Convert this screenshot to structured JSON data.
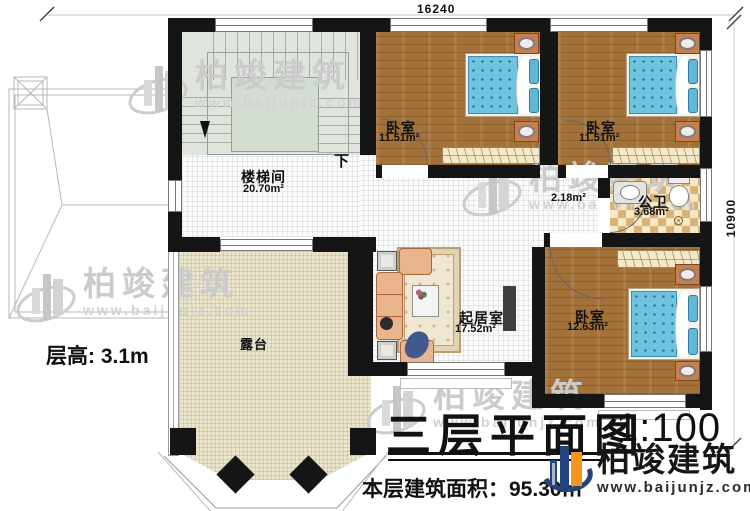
{
  "dimensions": {
    "top": "16240",
    "right": "10900"
  },
  "annotations": {
    "floor_height": "层高: 3.1m",
    "down": "下",
    "hall_area": "2.18m²"
  },
  "rooms": {
    "stairwell": {
      "name": "楼梯间",
      "area": "20.70m²"
    },
    "bedroom_a": {
      "name": "卧室",
      "area": "11.51m²"
    },
    "bedroom_b": {
      "name": "卧室",
      "area": "11.51m²"
    },
    "bathroom": {
      "name": "公卫",
      "area": "3.68m²"
    },
    "living": {
      "name": "起居室",
      "area": "17.52m²"
    },
    "bedroom_c": {
      "name": "卧室",
      "area": "12.63m²"
    },
    "terrace": {
      "name": "露台"
    }
  },
  "title_block": {
    "title": "三层平面图",
    "scale": "1:100",
    "area_note": "本层建筑面积：95.30㎡"
  },
  "brand": {
    "name": "柏竣建筑",
    "website": "www.baijunjz.com",
    "suffix": "、"
  },
  "watermark": {
    "name": "柏竣建筑",
    "website": "www.baijunjz.com"
  },
  "colors": {
    "wall": "#151515",
    "wood_floor": "#a3713a",
    "bed_blue": "#6fc3de",
    "terrace_floor": "#ebe5cb",
    "bath_checker": "#d8b277",
    "stair_floor": "#dfe5dd",
    "brand_blue": "#24457c",
    "brand_orange": "#f7941d"
  }
}
